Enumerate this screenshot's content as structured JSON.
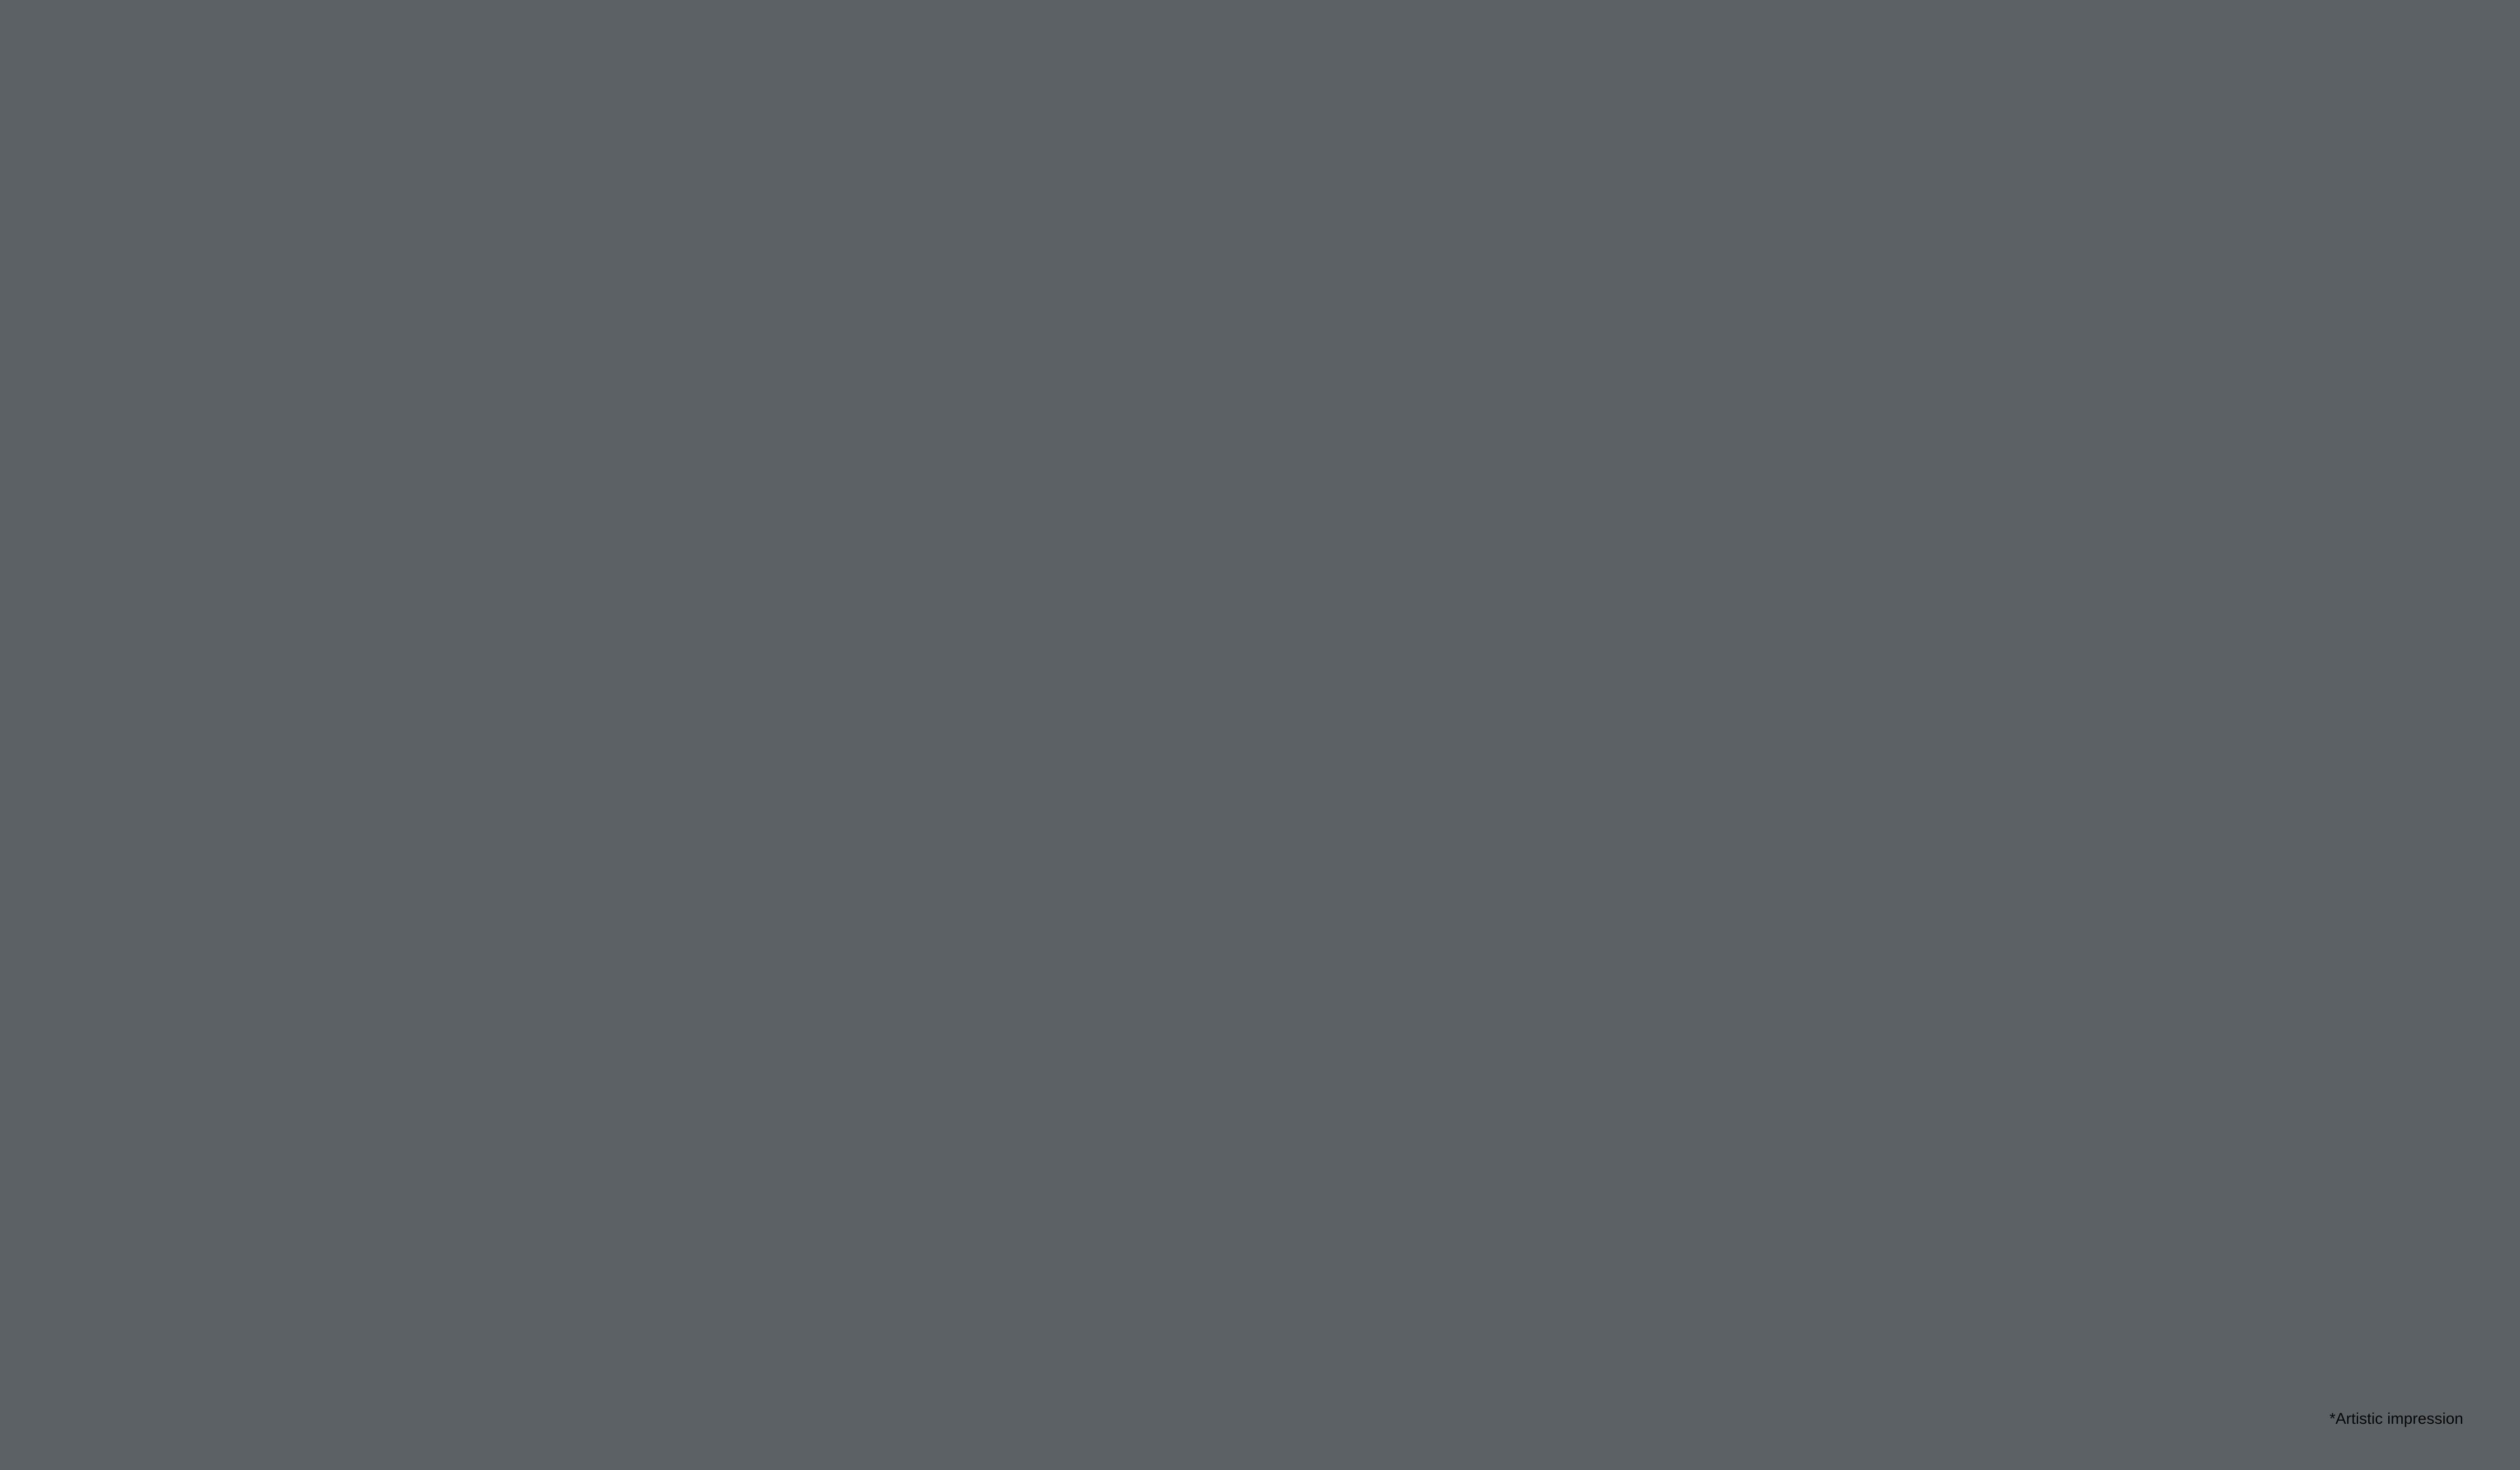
{
  "annotation": {
    "text": "*Artistic impression",
    "color": "#ffffff"
  },
  "palette": {
    "base": "#b7bab5",
    "dark_canopy": "#2e4a1e",
    "plaza": "#c6c8c2",
    "swirl": "#5f645e",
    "building_white": "#f3f4f6",
    "slab": "#fafbfc",
    "window_a": "#667066",
    "window_b": "#7b857b",
    "window_c": "#4e564e",
    "orange": "#e8871e",
    "left_face": "#eef0f3",
    "right_face": "#9096a6",
    "right_window": "#434a58",
    "right_mullion": "#ccd1dc",
    "opening": "#272c2e",
    "beam": "#f2f3f4",
    "apron_line": "#4e5254",
    "court_blue": "#36719f",
    "court_blue_light": "#7096b6",
    "tennis_blue": "#5b8fb8",
    "aisle": "#c8cac5",
    "court_line": "#f2f5f7",
    "turf": "#5f9c3c",
    "turf_dark": "#4f8a33",
    "curb": "#e9ebe7",
    "hedge": "#3a5f28",
    "lawn": "#7fa84e",
    "ring_light": "#d2d4cf",
    "ring_mid": "#999d98",
    "stone": "#c7a87e",
    "stone_dark": "#8f7354",
    "terrace_step": "#d6d8d3",
    "road": "#798084",
    "deck": "#b06a35",
    "deck_line": "#7a4517",
    "roof_green": "#7fae45",
    "glass_wall": "#8c96a5",
    "white_edge": "#e6e8e6",
    "play_blue": "#2b3fae",
    "play_red": "#c92f34",
    "play_yellow": "#ddd34f",
    "play_green": "#76a243",
    "play_gray": "#8f9793",
    "play_ground": "#a2a8a4",
    "bench_wood": "#b5772f",
    "planter_wood": "#a9712e",
    "lamp": "#2c2f2c",
    "goal_red": "#d04040",
    "tree_hi": "#79b544",
    "tree_mid": "#3f7023",
    "tree_lo": "#2c5219",
    "treeb_hi": "#5d8f37",
    "treeb_mid": "#33591f",
    "treeb_lo": "#23431a",
    "treec_hi": "#9cc75f",
    "treec_mid": "#5c8f33",
    "palm_hi": "#8fd14f",
    "palm_lo": "#4e8f26"
  },
  "cars": [
    "#3f4447",
    "#f0f1f2",
    "#70393b",
    "#e2802c",
    "#44372e",
    "#d9dcdf"
  ]
}
